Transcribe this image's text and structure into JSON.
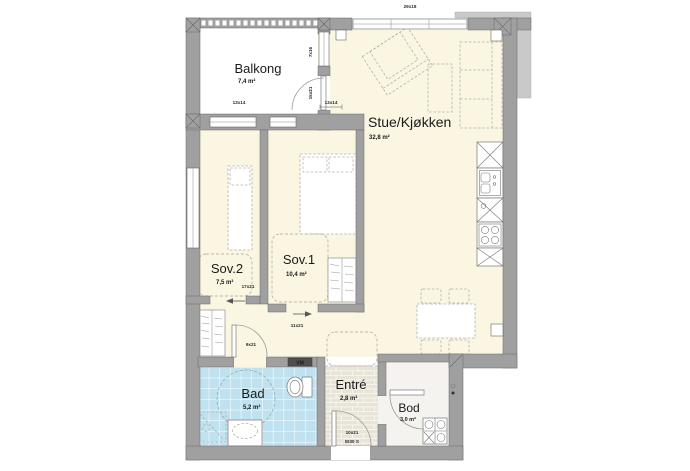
{
  "plan_title": "Apartment floor plan",
  "rooms": {
    "balkong": {
      "name": "Balkong",
      "area": "7,4 m²"
    },
    "stue": {
      "name": "Stue/Kjøkken",
      "area": "32,8 m²"
    },
    "sov2": {
      "name": "Sov.2",
      "area": "7,5 m²"
    },
    "sov1": {
      "name": "Sov.1",
      "area": "10,4 m²"
    },
    "bad": {
      "name": "Bad",
      "area": "5,2 m²"
    },
    "entre": {
      "name": "Entré",
      "area": "2,8 m²"
    },
    "bod": {
      "name": "Bod",
      "area": "3,0 m²"
    }
  },
  "labels": {
    "top_window": "29x18",
    "balcony_window": "13x14",
    "balcony_door": "13x14",
    "wall_window": "7x16",
    "wall_door": "15x21",
    "sov2_door": "17x21",
    "hall_door": "11x21",
    "bad_door": "9x21",
    "entry_door": "10x21",
    "entry_door_rating": "EI30 S",
    "washing_machine": "VM"
  },
  "colors": {
    "wall": "#a0a0a0",
    "wall_light": "#c9c9c9",
    "floor_main": "#faf6e2",
    "floor_bath": "#c0e2f0",
    "floor_entry": "#e8e4d8",
    "floor_bod": "#f4f3f0"
  }
}
